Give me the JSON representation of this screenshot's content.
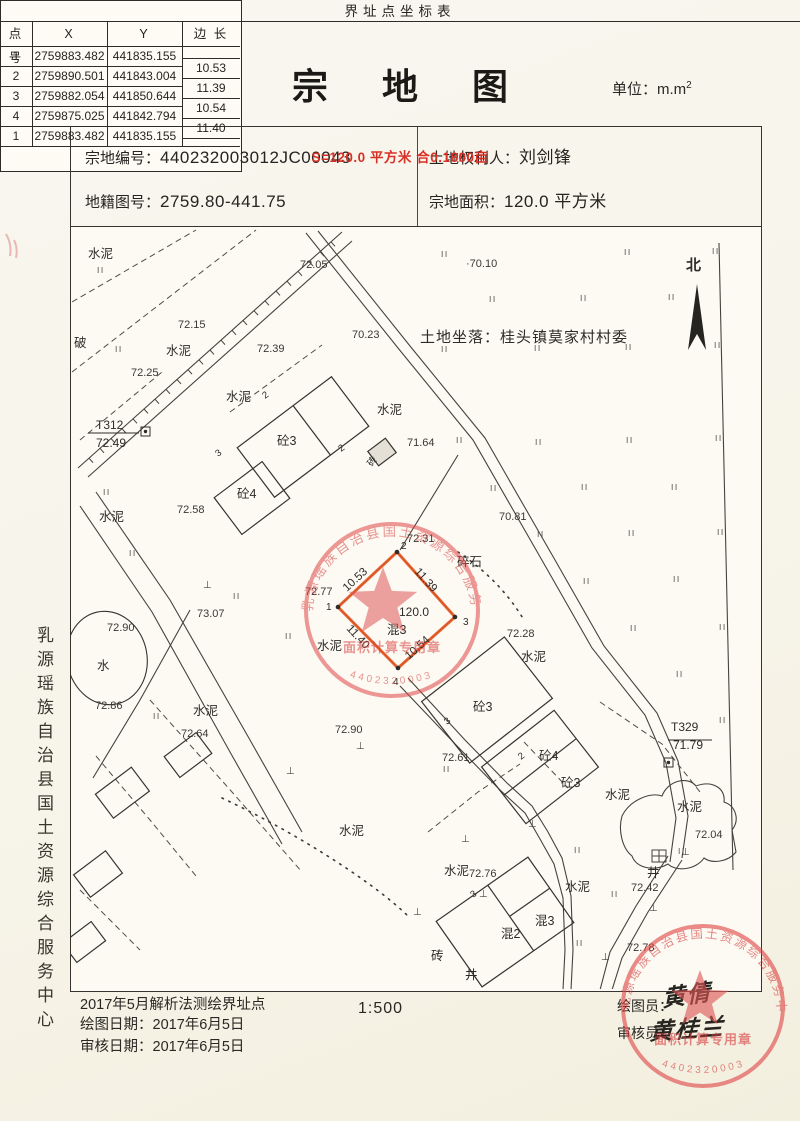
{
  "page": {
    "title": "宗 地 图",
    "unit_label": "单位：m.m",
    "unit_sup": "2"
  },
  "header": {
    "parcel_no_label": "宗地编号：",
    "parcel_no": "440232003012JC00043",
    "map_no_label": "地籍图号：",
    "map_no": "2759.80-441.75",
    "owner_label": "土地权利人：",
    "owner": "刘剑锋",
    "area_label": "宗地面积：",
    "area": "120.0  平方米"
  },
  "map": {
    "location": "土地坐落：桂头镇莫家村村委",
    "north_label": "北",
    "parcel": {
      "vertex_numbers": [
        "1",
        "2",
        "3",
        "4"
      ],
      "edge_lengths": [
        "10.53",
        "11.39",
        "10.54",
        "11.40"
      ],
      "area_label": "120.0",
      "structure": "混3",
      "boundary_color": "#e8541e"
    },
    "labels": [
      {
        "t": "水泥",
        "x": 88,
        "y": 258,
        "c": "lbl"
      },
      {
        "t": "破",
        "x": 74,
        "y": 347,
        "c": "lbl"
      },
      {
        "t": "72.15",
        "x": 178,
        "y": 328,
        "c": "elev"
      },
      {
        "t": "水泥",
        "x": 166,
        "y": 355,
        "c": "lbl"
      },
      {
        "t": "72.25",
        "x": 131,
        "y": 376,
        "c": "elev"
      },
      {
        "t": "T312",
        "x": 96,
        "y": 429,
        "c": "ctrl"
      },
      {
        "t": "72.49",
        "x": 96,
        "y": 447,
        "c": "ctrl"
      },
      {
        "t": "72.05",
        "x": 300,
        "y": 268,
        "c": "elev"
      },
      {
        "t": "·70.10",
        "x": 466,
        "y": 267,
        "c": "elev"
      },
      {
        "t": "70.23",
        "x": 352,
        "y": 338,
        "c": "elev"
      },
      {
        "t": "72.39",
        "x": 257,
        "y": 352,
        "c": "elev"
      },
      {
        "t": "水泥",
        "x": 226,
        "y": 401,
        "c": "lbl"
      },
      {
        "t": "水泥",
        "x": 377,
        "y": 414,
        "c": "lbl"
      },
      {
        "t": "砼3",
        "x": 277,
        "y": 445,
        "c": "lbl"
      },
      {
        "t": "71.64",
        "x": 407,
        "y": 446,
        "c": "elev"
      },
      {
        "t": "砖",
        "x": 372,
        "y": 467,
        "r": -55,
        "c": "bnum"
      },
      {
        "t": "砼4",
        "x": 237,
        "y": 498,
        "c": "lbl"
      },
      {
        "t": "72.58",
        "x": 177,
        "y": 513,
        "c": "elev"
      },
      {
        "t": "水泥",
        "x": 99,
        "y": 521,
        "c": "lbl"
      },
      {
        "t": "72.31",
        "x": 407,
        "y": 542,
        "c": "elev"
      },
      {
        "t": "碎石",
        "x": 457,
        "y": 566,
        "c": "lbl"
      },
      {
        "t": "70.81",
        "x": 499,
        "y": 520,
        "c": "elev"
      },
      {
        "t": "72.77",
        "x": 305,
        "y": 595,
        "c": "elev"
      },
      {
        "t": "120.0",
        "x": 399,
        "y": 616,
        "c": "area"
      },
      {
        "t": "混3",
        "x": 387,
        "y": 634,
        "c": "lbl"
      },
      {
        "t": "水泥",
        "x": 317,
        "y": 650,
        "c": "lbl"
      },
      {
        "t": "72.28",
        "x": 507,
        "y": 637,
        "c": "elev"
      },
      {
        "t": "水泥",
        "x": 521,
        "y": 661,
        "c": "lbl"
      },
      {
        "t": "73.07",
        "x": 197,
        "y": 617,
        "c": "elev"
      },
      {
        "t": "72.90",
        "x": 107,
        "y": 631,
        "c": "elev"
      },
      {
        "t": "水",
        "x": 97,
        "y": 670,
        "c": "lbl"
      },
      {
        "t": "72.86",
        "x": 95,
        "y": 709,
        "c": "elev"
      },
      {
        "t": "水泥",
        "x": 193,
        "y": 715,
        "c": "lbl"
      },
      {
        "t": "72.64",
        "x": 181,
        "y": 737,
        "c": "elev"
      },
      {
        "t": "72.90",
        "x": 335,
        "y": 733,
        "c": "elev"
      },
      {
        "t": "水泥",
        "x": 339,
        "y": 835,
        "c": "lbl"
      },
      {
        "t": "砼3",
        "x": 473,
        "y": 711,
        "c": "lbl"
      },
      {
        "t": "72.61",
        "x": 442,
        "y": 761,
        "c": "elev"
      },
      {
        "t": "砼4",
        "x": 539,
        "y": 760,
        "c": "lbl"
      },
      {
        "t": "砼3",
        "x": 561,
        "y": 787,
        "c": "lbl"
      },
      {
        "t": "水泥",
        "x": 605,
        "y": 799,
        "c": "lbl"
      },
      {
        "t": "T329",
        "x": 671,
        "y": 731,
        "c": "ctrl"
      },
      {
        "t": "71.79",
        "x": 673,
        "y": 749,
        "c": "ctrl"
      },
      {
        "t": "水泥",
        "x": 677,
        "y": 811,
        "c": "lbl"
      },
      {
        "t": "72.04",
        "x": 695,
        "y": 838,
        "c": "elev"
      },
      {
        "t": "72.76",
        "x": 469,
        "y": 877,
        "c": "elev"
      },
      {
        "t": "水泥",
        "x": 444,
        "y": 875,
        "c": "lbl"
      },
      {
        "t": "水泥",
        "x": 565,
        "y": 891,
        "c": "lbl"
      },
      {
        "t": "混3",
        "x": 535,
        "y": 925,
        "c": "lbl"
      },
      {
        "t": "混2",
        "x": 501,
        "y": 938,
        "c": "lbl"
      },
      {
        "t": "井",
        "x": 647,
        "y": 877,
        "c": "lbl"
      },
      {
        "t": "72.42",
        "x": 631,
        "y": 891,
        "c": "elev"
      },
      {
        "t": "72.78",
        "x": 627,
        "y": 951,
        "c": "elev"
      },
      {
        "t": "井",
        "x": 465,
        "y": 979,
        "c": "lbl"
      },
      {
        "t": "砖",
        "x": 431,
        "y": 960,
        "c": "lbl"
      },
      {
        "t": "北",
        "x": 686,
        "y": 270,
        "c": "north"
      },
      {
        "t": "10.53",
        "x": 347,
        "y": 592,
        "r": -43,
        "c": "edge"
      },
      {
        "t": "11.39",
        "x": 414,
        "y": 572,
        "r": 48,
        "c": "edge"
      },
      {
        "t": "10.54",
        "x": 409,
        "y": 660,
        "r": -42,
        "c": "edge"
      },
      {
        "t": "11.40",
        "x": 346,
        "y": 629,
        "r": 47,
        "c": "edge"
      },
      {
        "t": "1",
        "x": 326,
        "y": 610,
        "c": "vx"
      },
      {
        "t": "2",
        "x": 401,
        "y": 549,
        "c": "vx"
      },
      {
        "t": "3",
        "x": 463,
        "y": 625,
        "c": "vx"
      },
      {
        "t": "4",
        "x": 393,
        "y": 685,
        "c": "vx"
      },
      {
        "t": "2",
        "x": 265,
        "y": 399,
        "r": -36,
        "c": "bnum"
      },
      {
        "t": "3",
        "x": 218,
        "y": 457,
        "r": -36,
        "c": "bnum"
      },
      {
        "t": "2",
        "x": 341,
        "y": 452,
        "r": -36,
        "c": "bnum"
      },
      {
        "t": "3",
        "x": 447,
        "y": 725,
        "r": -38,
        "c": "bnum"
      },
      {
        "t": "2",
        "x": 521,
        "y": 760,
        "r": -38,
        "c": "bnum"
      },
      {
        "t": "3",
        "x": 473,
        "y": 898,
        "r": -35,
        "c": "bnum"
      }
    ],
    "grass": [
      [
        441,
        257
      ],
      [
        624,
        255
      ],
      [
        712,
        254
      ],
      [
        489,
        302
      ],
      [
        580,
        301
      ],
      [
        668,
        300
      ],
      [
        441,
        352
      ],
      [
        534,
        351
      ],
      [
        625,
        350
      ],
      [
        714,
        348
      ],
      [
        456,
        443
      ],
      [
        535,
        445
      ],
      [
        626,
        443
      ],
      [
        715,
        441
      ],
      [
        490,
        491
      ],
      [
        581,
        490
      ],
      [
        671,
        490
      ],
      [
        537,
        537
      ],
      [
        628,
        536
      ],
      [
        717,
        535
      ],
      [
        583,
        584
      ],
      [
        673,
        582
      ],
      [
        630,
        631
      ],
      [
        719,
        630
      ],
      [
        676,
        677
      ],
      [
        719,
        723
      ],
      [
        443,
        772
      ],
      [
        574,
        853
      ],
      [
        611,
        897
      ],
      [
        576,
        946
      ],
      [
        678,
        854
      ],
      [
        97,
        273
      ],
      [
        115,
        352
      ],
      [
        103,
        495
      ],
      [
        129,
        556
      ],
      [
        233,
        599
      ],
      [
        285,
        639
      ],
      [
        153,
        719
      ]
    ],
    "ground_marks": [
      [
        203,
        588
      ],
      [
        356,
        749
      ],
      [
        286,
        774
      ],
      [
        528,
        827
      ],
      [
        461,
        842
      ],
      [
        681,
        855
      ],
      [
        649,
        911
      ],
      [
        479,
        897
      ],
      [
        413,
        915
      ],
      [
        601,
        960
      ]
    ]
  },
  "table": {
    "title": "界址点坐标表",
    "headers": [
      "点 号",
      "X",
      "Y",
      "边 长"
    ],
    "rows": [
      [
        "1",
        "2759883.482",
        "441835.155"
      ],
      [
        "2",
        "2759890.501",
        "441843.004"
      ],
      [
        "3",
        "2759882.054",
        "441850.644"
      ],
      [
        "4",
        "2759875.025",
        "441842.794"
      ],
      [
        "1",
        "2759883.482",
        "441835.155"
      ]
    ],
    "edge_lengths": [
      "10.53",
      "11.39",
      "10.54",
      "11.40"
    ],
    "summary": "S=120.0 平方米 合0.1800亩"
  },
  "footer": {
    "method": "2017年5月解析法测绘界址点",
    "draw_date": "绘图日期：2017年6月5日",
    "review_date": "审核日期：2017年6月5日",
    "scale": "1:500",
    "drafter_label": "绘图员：",
    "drafter_sig": "黄倩",
    "reviewer_label": "审核员：",
    "reviewer_sig": "黄桂兰"
  },
  "side_text": "乳源瑶族自治县国土资源综合服务中心",
  "stamps": {
    "org": "乳源瑶族自治县国土资源综合服务中心",
    "banner": "面积计算专用章",
    "code": "4402320003"
  }
}
